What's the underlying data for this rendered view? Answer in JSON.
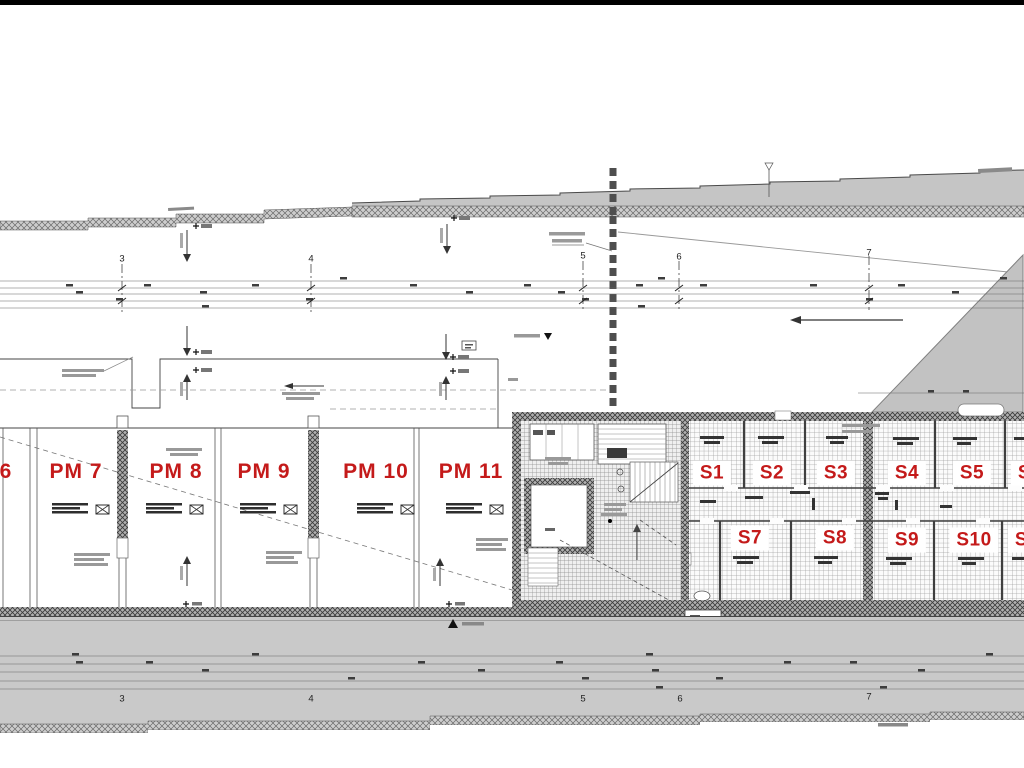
{
  "page": {
    "background": "#ffffff"
  },
  "colors": {
    "label_red": "#c41a1a",
    "terrain_gray": "#c5c5c5",
    "road_gray": "#c9c9c9"
  },
  "plan": {
    "parking_labels": [
      {
        "text": "6",
        "x": 6,
        "y": 472
      },
      {
        "text": "PM 7",
        "x": 76,
        "y": 472
      },
      {
        "text": "PM 8",
        "x": 176,
        "y": 472
      },
      {
        "text": "PM 9",
        "x": 264,
        "y": 472
      },
      {
        "text": "PM 10",
        "x": 376,
        "y": 472
      },
      {
        "text": "PM 11",
        "x": 471,
        "y": 472
      }
    ],
    "storage_labels": [
      {
        "text": "S1",
        "x": 712,
        "y": 473
      },
      {
        "text": "S2",
        "x": 772,
        "y": 473
      },
      {
        "text": "S3",
        "x": 836,
        "y": 473
      },
      {
        "text": "S4",
        "x": 907,
        "y": 473
      },
      {
        "text": "S5",
        "x": 972,
        "y": 473
      },
      {
        "text": "S6",
        "x": 1030,
        "y": 473
      },
      {
        "text": "S7",
        "x": 750,
        "y": 538
      },
      {
        "text": "S8",
        "x": 835,
        "y": 538
      },
      {
        "text": "S9",
        "x": 907,
        "y": 540
      },
      {
        "text": "S10",
        "x": 974,
        "y": 540
      },
      {
        "text": "S11",
        "x": 1032,
        "y": 540
      }
    ],
    "axis_numbers": [
      {
        "text": "3",
        "x": 122,
        "y": 259
      },
      {
        "text": "4",
        "x": 311,
        "y": 259
      },
      {
        "text": "5",
        "x": 583,
        "y": 256
      },
      {
        "text": "6",
        "x": 679,
        "y": 257
      },
      {
        "text": "7",
        "x": 869,
        "y": 253
      },
      {
        "text": "3",
        "x": 122,
        "y": 699
      },
      {
        "text": "4",
        "x": 311,
        "y": 699
      },
      {
        "text": "5",
        "x": 583,
        "y": 699
      },
      {
        "text": "6",
        "x": 680,
        "y": 699
      },
      {
        "text": "7",
        "x": 869,
        "y": 697
      }
    ]
  }
}
